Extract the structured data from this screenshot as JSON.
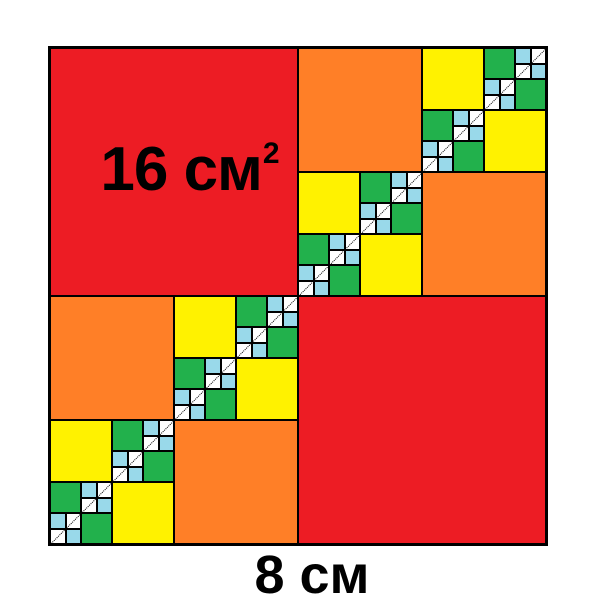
{
  "page": {
    "background": "#FFFFFF"
  },
  "diagram": {
    "outer_side_cm": 8,
    "side_label": "8 см",
    "area_label_base": "16 см",
    "area_label_sup": "2",
    "border_color": "#000000",
    "diagonal_line_color": "#000000",
    "palette": {
      "red": "#ED1C24",
      "orange": "#FF7F27",
      "yellow": "#FFF200",
      "green": "#22B14C",
      "light_blue": "#99D9EA",
      "white": "#FFFFFF"
    },
    "levels": [
      {
        "color_name": "red",
        "square_side_cm": 4,
        "square_area_cm2": 16
      },
      {
        "color_name": "orange",
        "square_side_cm": 2,
        "square_area_cm2": 4
      },
      {
        "color_name": "yellow",
        "square_side_cm": 1,
        "square_area_cm2": 1
      },
      {
        "color_name": "green",
        "square_side_cm": 0.5,
        "square_area_cm2": 0.25
      },
      {
        "color_name": "light_blue",
        "square_side_cm": 0.25,
        "square_area_cm2": 0.0625
      },
      {
        "color_name": "white",
        "square_side_cm": 0.25,
        "square_area_cm2": 0.0625
      }
    ]
  }
}
